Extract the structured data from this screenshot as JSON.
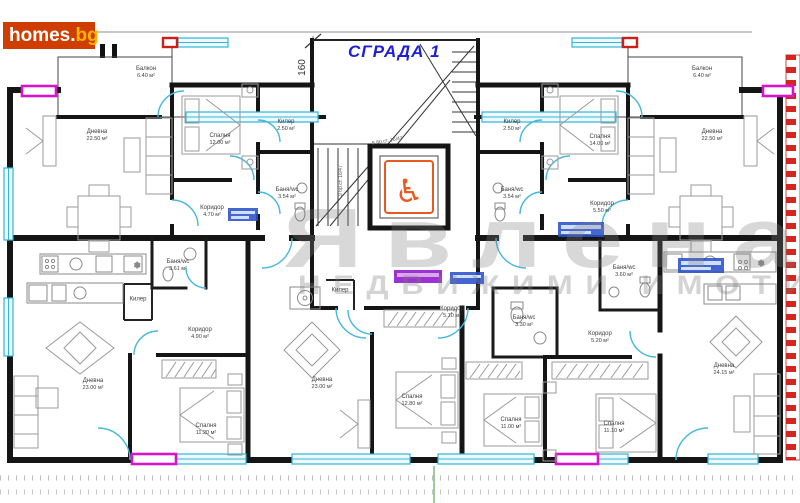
{
  "brand": {
    "logo_main": "homes.",
    "logo_accent": "bg"
  },
  "plan": {
    "title": "СГРАДА 1",
    "dimension": "160",
    "stair_note_lower": "9 бр.ст. 16/47",
    "stair_note_upper": "5 бр.ст. 16/47",
    "elevator_symbol": "♿"
  },
  "watermark": {
    "line1": "Явлена",
    "line2": "НЕДВИЖИМИ ИМОТИ"
  },
  "icons": {
    "snowflake": "❄"
  },
  "colors": {
    "walls": "#151515",
    "windows_cyan": "#2fb6d9",
    "accent_magenta": "#d616c8",
    "accent_red": "#cc1f1a",
    "elevator_orange": "#e85a1e",
    "title_blue": "#1f1fd4",
    "logo_bg": "#cf3e00",
    "logo_accent": "#ffb400"
  },
  "rooms": [
    {
      "label": "Балкон",
      "area": "6.40 м²",
      "x": 146,
      "y": 73
    },
    {
      "label": "Дневна",
      "area": "22.50 м²",
      "x": 97,
      "y": 136
    },
    {
      "label": "Спалня",
      "area": "12.00 м²",
      "x": 220,
      "y": 140
    },
    {
      "label": "Килер",
      "area": "2.50 м²",
      "x": 286,
      "y": 126
    },
    {
      "label": "Баня/wc",
      "area": "3.54 м²",
      "x": 287,
      "y": 194
    },
    {
      "label": "Коридор",
      "area": "4.70 м²",
      "x": 212,
      "y": 212
    },
    {
      "label": "Балкон",
      "area": "6.40 м²",
      "x": 702,
      "y": 73
    },
    {
      "label": "Дневна",
      "area": "22.50 м²",
      "x": 712,
      "y": 136
    },
    {
      "label": "Спалня",
      "area": "14.00 м²",
      "x": 600,
      "y": 141
    },
    {
      "label": "Килер",
      "area": "2.50 м²",
      "x": 512,
      "y": 126
    },
    {
      "label": "Баня/wc",
      "area": "3.54 м²",
      "x": 512,
      "y": 194
    },
    {
      "label": "Коридор",
      "area": "5.50 м²",
      "x": 602,
      "y": 208
    },
    {
      "label": "Баня/wc",
      "area": "3.61 м²",
      "x": 178,
      "y": 266
    },
    {
      "label": "Килер",
      "area": "",
      "x": 138,
      "y": 300
    },
    {
      "label": "Коридор",
      "area": "4.90 м²",
      "x": 200,
      "y": 334
    },
    {
      "label": "Дневна",
      "area": "23.00 м²",
      "x": 93,
      "y": 385
    },
    {
      "label": "Спалня",
      "area": "11.20 м²",
      "x": 206,
      "y": 430
    },
    {
      "label": "Килер",
      "area": "",
      "x": 340,
      "y": 291
    },
    {
      "label": "Коридор",
      "area": "5.10 м²",
      "x": 452,
      "y": 313
    },
    {
      "label": "Баня/wc",
      "area": "3.30 м²",
      "x": 524,
      "y": 322
    },
    {
      "label": "Дневна",
      "area": "23.00 м²",
      "x": 322,
      "y": 384
    },
    {
      "label": "Спалня",
      "area": "12.80 м²",
      "x": 412,
      "y": 401
    },
    {
      "label": "Баня/wc",
      "area": "3.60 м²",
      "x": 624,
      "y": 272
    },
    {
      "label": "Коридор",
      "area": "5.20 м²",
      "x": 600,
      "y": 338
    },
    {
      "label": "Спалня",
      "area": "11.00 м²",
      "x": 511,
      "y": 424
    },
    {
      "label": "Спалня",
      "area": "11.10 м²",
      "x": 614,
      "y": 428
    },
    {
      "label": "Дневна",
      "area": "24.15 м²",
      "x": 724,
      "y": 370
    }
  ]
}
